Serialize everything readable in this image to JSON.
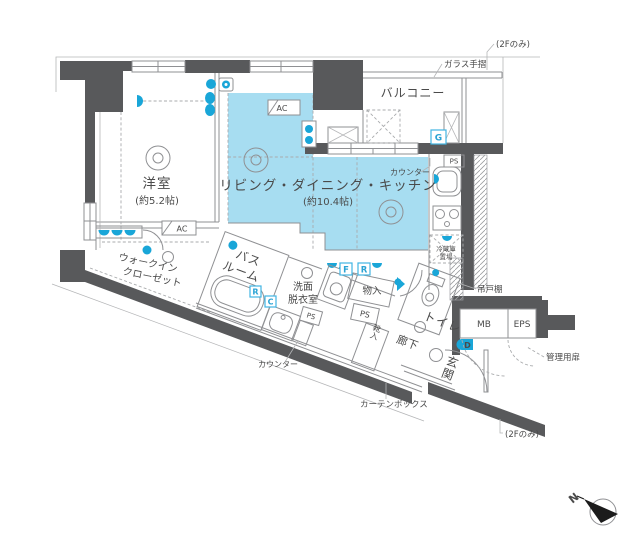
{
  "colors": {
    "wall": "#58595b",
    "ldk_highlight": "#a7ddf1",
    "fixture_blue": "#19a6d8",
    "marker_blue": "#41b4e2",
    "text": "#4a4a4a"
  },
  "rooms": {
    "western": {
      "name": "洋室",
      "size": "(約5.2帖)"
    },
    "ldk": {
      "name": "リビング・ダイニング・キッチン",
      "size": "(約10.4帖)"
    },
    "balcony": {
      "name": "バルコニー"
    },
    "wic": {
      "line1": "ウォークイン",
      "line2": "クローゼット"
    },
    "bath": {
      "line1": "バス",
      "line2": "ルーム"
    },
    "washroom": {
      "line1": "洗面",
      "line2": "脱衣室"
    },
    "toilet": {
      "name": "トイレ"
    },
    "hallway": {
      "name": "廊下"
    },
    "entrance": {
      "name": "玄関"
    },
    "storage": {
      "name": "物入"
    },
    "shoes": {
      "name": "靴入"
    },
    "mb": {
      "name": "MB"
    },
    "eps": {
      "name": "EPS"
    }
  },
  "annotations": {
    "only2f_top": "(2Fのみ)",
    "only2f_bottom": "(2Fのみ)",
    "glass_rail": "ガラス手摺",
    "counter_kitchen": "カウンター",
    "counter_wash": "カウンター",
    "curtain_box": "カーテンボックス",
    "hanging_shelf": "吊戸棚",
    "service_door": "管理用扉",
    "fridge": {
      "line1": "冷蔵庫",
      "line2": "置場"
    }
  },
  "markers": {
    "ac_ldk": "AC",
    "ac_western": "AC",
    "gas": "G",
    "fan_f": "F",
    "fan_r": "R",
    "bath_r": "R",
    "bath_c": "C",
    "door_d": "D",
    "ps_kitchen": "PS",
    "ps_hall": "PS",
    "ps_bath": "PS",
    "north": "N"
  }
}
